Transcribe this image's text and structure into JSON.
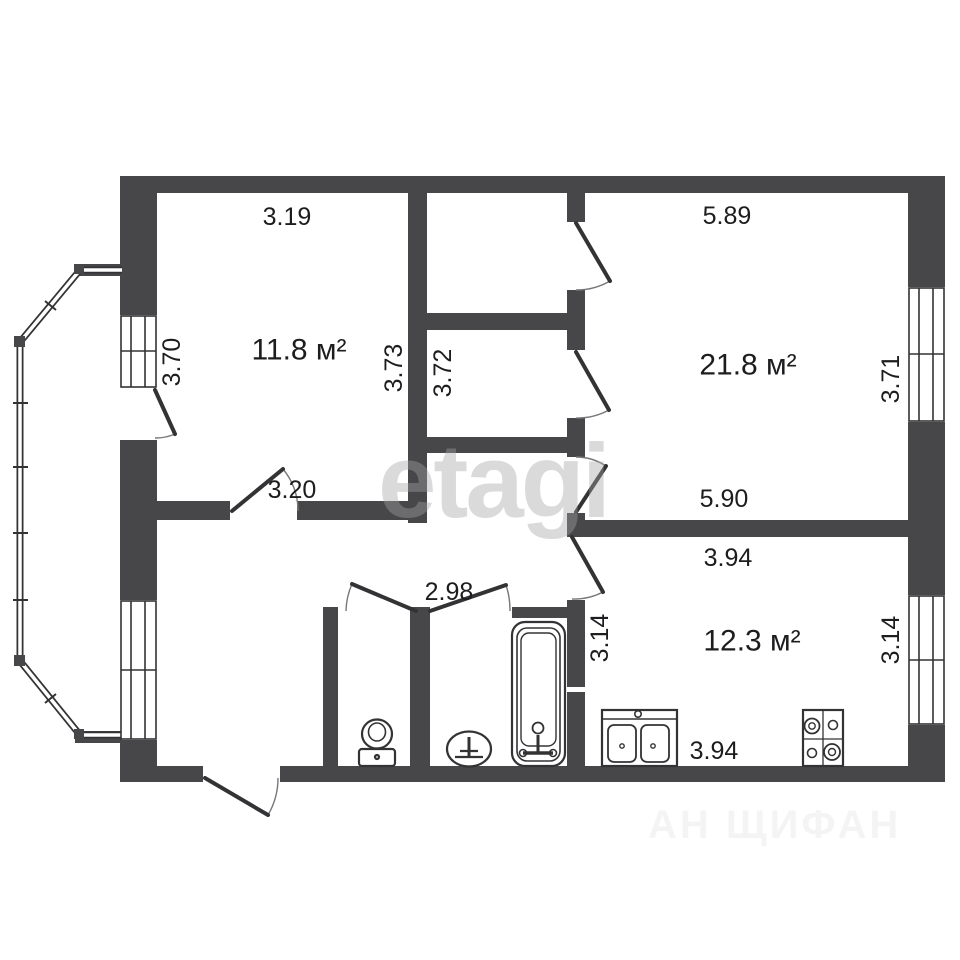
{
  "title": "apartment floor plan",
  "colors": {
    "wall": "#474749",
    "line": "#333335",
    "line_light": "#777779",
    "text": "#1d1d1f",
    "watermark": "#a5a5a5",
    "watermark2": "#b9b2b9",
    "bg": "#ffffff"
  },
  "rooms": [
    {
      "id": "bedroom",
      "area": "11.8 м²",
      "dims": {
        "top": "3.19",
        "left": "3.70",
        "right": "3.73",
        "door": "3.20"
      }
    },
    {
      "id": "closet",
      "dims": {
        "width": "3.72"
      }
    },
    {
      "id": "living-room",
      "area": "21.8 м²",
      "dims": {
        "top": "5.89",
        "right": "3.71",
        "bottom": "5.90"
      }
    },
    {
      "id": "kitchen",
      "area": "12.3 м²",
      "dims": {
        "top": "3.94",
        "left": "3.14",
        "right": "3.14",
        "bottom": "3.94"
      }
    },
    {
      "id": "bathroom",
      "dims": {
        "width": "2.98"
      }
    }
  ],
  "fixtures": [
    "toilet",
    "washbasin",
    "bathtub",
    "kitchen-sink",
    "stove"
  ],
  "features": [
    "balcony-glazing",
    "entrance-door",
    "windows"
  ],
  "watermarks": {
    "center": "etagi",
    "bottom_right": "АН ЩИФАН"
  }
}
